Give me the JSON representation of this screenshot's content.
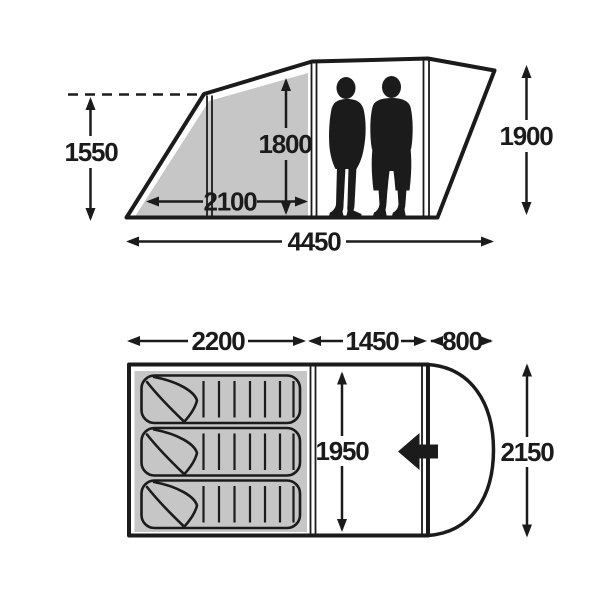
{
  "title": "tent-dimensions-diagram",
  "colors": {
    "line": "#1b1b1b",
    "panel_gray": "#c5c6c5",
    "background": "#ffffff"
  },
  "side_view": {
    "peak_height": "1550",
    "bedroom_floor_length": "2100",
    "interior_height": "1800",
    "max_height": "1900",
    "overall_length": "4450"
  },
  "floor_plan": {
    "bedroom_length": "2200",
    "living_room_length": "1450",
    "porch_depth": "800",
    "inner_width": "1950",
    "overall_width": "2150",
    "sleeping_bag_count": 3
  }
}
